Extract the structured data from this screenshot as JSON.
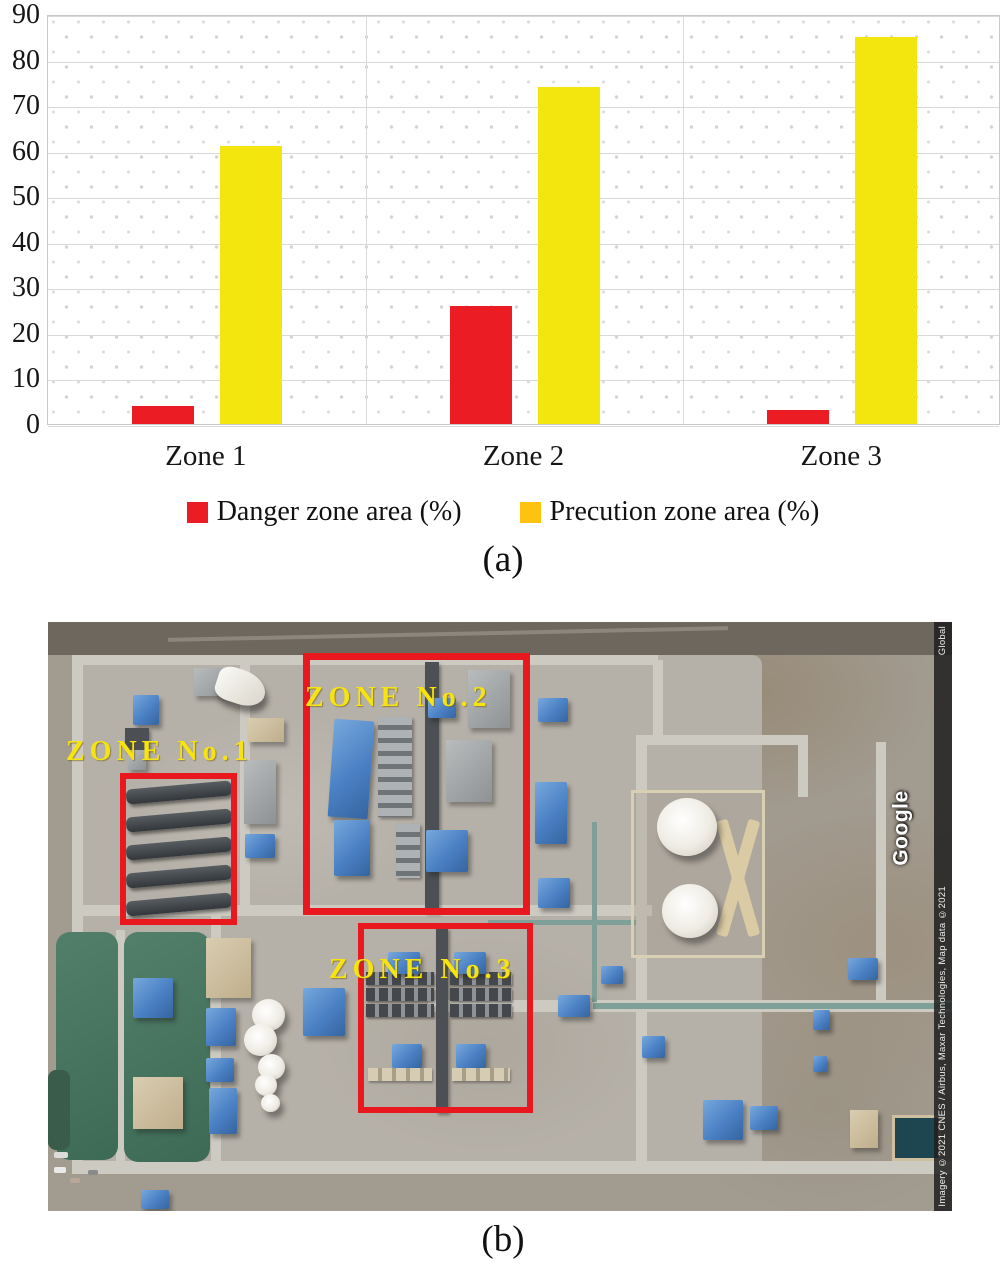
{
  "figure": {
    "caption_a": "(a)",
    "caption_b": "(b)"
  },
  "chart_data": {
    "type": "bar",
    "categories": [
      "Zone 1",
      "Zone 2",
      "Zone 3"
    ],
    "series": [
      {
        "name": "Danger zone area (%)",
        "color": "#ec1c24",
        "legend_color": "#ec1c24",
        "values": [
          4,
          26,
          3
        ]
      },
      {
        "name": "Precution zone area (%)",
        "color": "#f2e60e",
        "legend_color": "#ffc20e",
        "values": [
          61,
          74,
          85
        ]
      }
    ],
    "title": "",
    "xlabel": "",
    "ylabel": "",
    "ylim": [
      0,
      90
    ],
    "ytick_step": 10,
    "grid": true,
    "legend_position": "bottom"
  },
  "map": {
    "zones": [
      {
        "label": "ZONE No.1"
      },
      {
        "label": "ZONE No.2"
      },
      {
        "label": "ZONE No.3"
      }
    ],
    "label_color": "#f6e312",
    "zone_box_color": "#e9171e",
    "watermark": "Google",
    "attribution": "Imagery ©2021 CNES / Airbus, Maxar Technologies, Map data ©2021",
    "attribution_right": "Global"
  }
}
